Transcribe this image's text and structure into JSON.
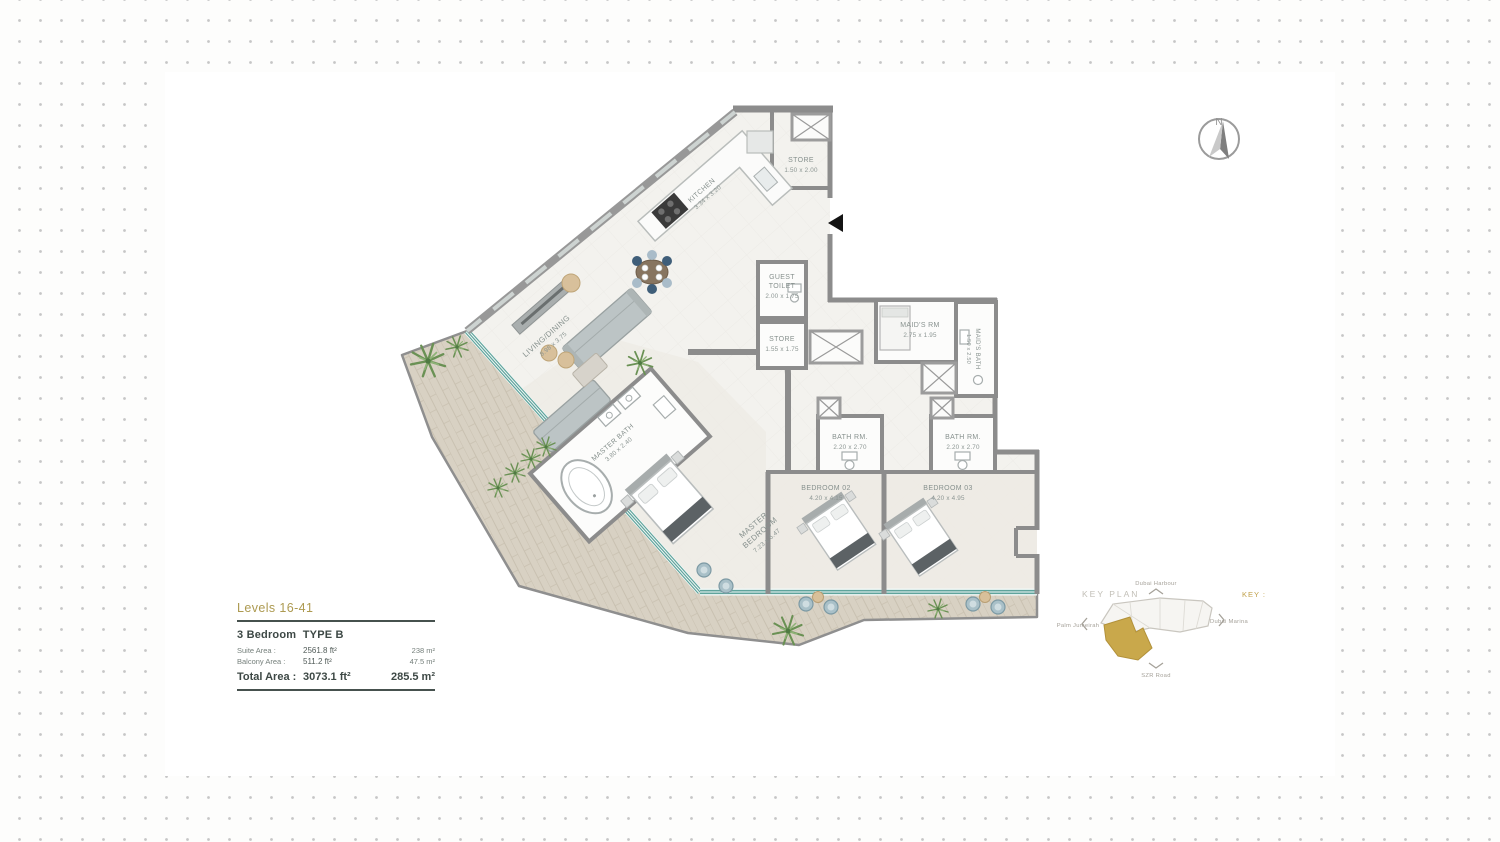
{
  "legend": {
    "levels": "Levels 16-41",
    "unit_type": "3 Bedroom  TYPE B",
    "rows": [
      {
        "label": "Suite Area :",
        "ft": "2561.8 ft²",
        "m": "238 m²"
      },
      {
        "label": "Balcony Area :",
        "ft": "511.2 ft²",
        "m": "47.5 m²"
      }
    ],
    "total": {
      "label": "Total Area :",
      "ft": "3073.1 ft²",
      "m": "285.5 m²"
    }
  },
  "plan": {
    "compass": {
      "north": "N"
    },
    "rooms": {
      "living": {
        "name": "LIVING/DINING",
        "dims": "8.98 x 3.75"
      },
      "kitchen": {
        "name": "KITCHEN",
        "dims": "3.34 x 3.20"
      },
      "store_top": {
        "name": "STORE",
        "dims": "1.50 x 2.00"
      },
      "guest_toilet": {
        "name_line1": "GUEST",
        "name_line2": "TOILET",
        "dims": "2.00 x 1.75"
      },
      "store_hall": {
        "name": "STORE",
        "dims": "1.55 x 1.75"
      },
      "maids_room": {
        "name": "MAID'S RM",
        "dims": "2.75 x 1.95"
      },
      "maids_bath": {
        "name": "MAID'S BATH",
        "dims": "1.50 x 2.50"
      },
      "bath_1": {
        "name": "BATH RM.",
        "dims": "2.20 x 2.70"
      },
      "bath_2": {
        "name": "BATH RM.",
        "dims": "2.20 x 2.70"
      },
      "bedroom_02": {
        "name": "BEDROOM 02",
        "dims": "4.20 x 4.15"
      },
      "bedroom_03": {
        "name": "BEDROOM 03",
        "dims": "4.20 x 4.95"
      },
      "master_bath": {
        "name": "MASTER BATH",
        "dims": "3.80 x 2.40"
      },
      "master_bedroom": {
        "name_line1": "MASTER",
        "name_line2": "BEDROOM",
        "dims": "7.23 x 6.47"
      }
    }
  },
  "key_plan": {
    "title": "KEY PLAN",
    "key_label": "KEY :",
    "directions": {
      "north": "Dubai Harbour",
      "south": "SZR Road",
      "east": "Dubai Marina",
      "west": "Palm Jumeirah"
    },
    "highlight_color": "#c9a84b"
  }
}
